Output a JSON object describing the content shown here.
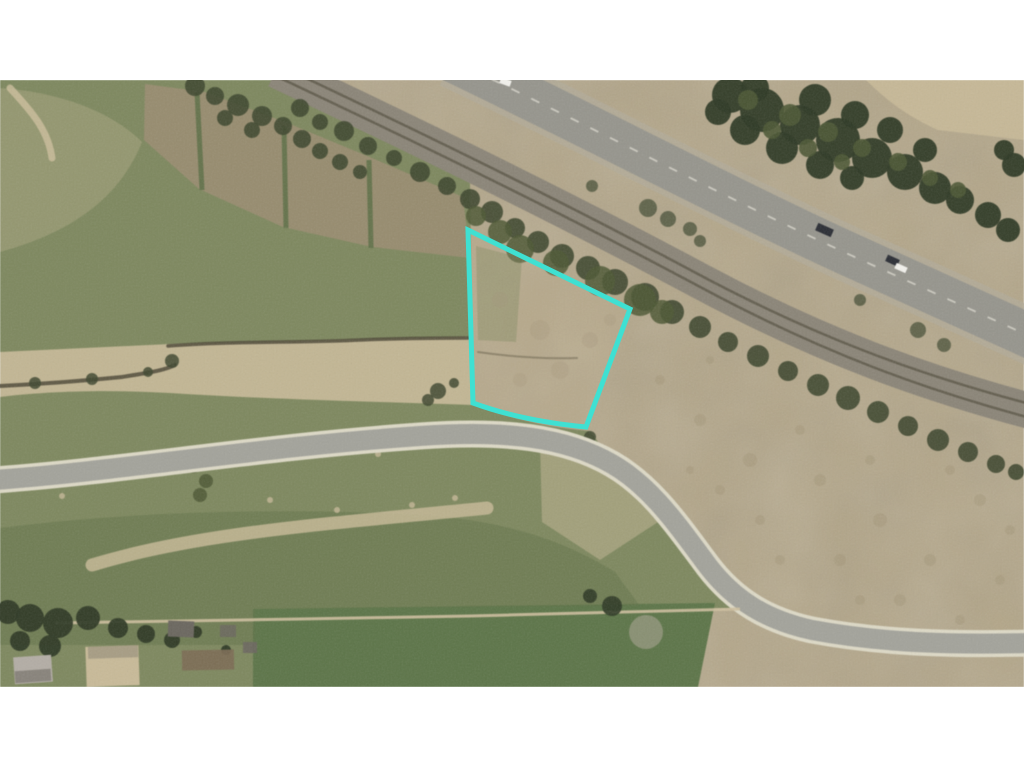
{
  "scene": {
    "width": 1024,
    "height": 768,
    "image_top": 80,
    "image_bottom": 687,
    "kind": "aerial-parcel-photo"
  },
  "palette": {
    "white": "#ffffff",
    "base_tan": "#b3a689",
    "dirt_light": "#c6b897",
    "dirt_dark": "#9b8d72",
    "grass": "#7e885f",
    "grass_dark": "#5f7048",
    "field_green": "#5d7549",
    "tree_dark": "#2f3a26",
    "tree_mid": "#4d5835",
    "bush": "#3f4830",
    "sage": "#8e9478",
    "road_gray": "#a3a39b",
    "road_edge": "#ddd9c6",
    "hwy_gray": "#96958d",
    "hwy_shoulder": "#b1ab9a",
    "hwy_line": "#d8d6cc",
    "rail_gray": "#8b8578",
    "rail_dark": "#544f3f",
    "ditch": "#4f4a38",
    "path_tan": "#cdbf9e",
    "roof_gray": "#b3ada5",
    "roof_dark": "#6b675f",
    "roof_tan": "#c8ba98",
    "garden_brown": "#7c6c54",
    "cyan": "#3fe0d2",
    "car_dark": "#2b2e35",
    "car_white": "#f2f1ec"
  },
  "parcel": {
    "stroke": "#3fe0d2",
    "stroke_width": 5,
    "vertices": [
      [
        468,
        230
      ],
      [
        630,
        309
      ],
      [
        586,
        427
      ],
      [
        473,
        403
      ]
    ]
  },
  "paths": {
    "imageArea": "M0,80 L1024,80 L1024,687 L0,687 Z",
    "grassMain": "M0,80 L285,80 C350,110 420,152 470,182 L473,403 C512,420 552,428 590,431 L628,482 C650,512 672,540 697,565 C715,583 733,597 752,608 L255,610 L255,687 L0,687 Z",
    "fieldBottom": "M253,609 L715,603 L698,687 L253,687 Z",
    "topRightField": "M866,80 L1024,80 L1024,140 L938,130 C906,116 884,98 866,80 Z",
    "washLight": "M0,88 C60,92 112,112 142,142 C122,192 80,230 0,252 Z",
    "washDark": "M0,528 C140,510 300,508 420,515 C500,520 560,538 615,572 L640,606 L255,609 L255,645 L0,645 Z",
    "washInnerCurve": "M540,442 L628,472 L658,522 L600,560 L542,522 Z",
    "ditchBand": "M0,352 L170,344 L470,337 L473,405 C390,402 280,400 170,393 C100,389 40,392 0,397 Z",
    "grassTuft": "M476,246 L522,258 L516,342 L478,340 Z",
    "stripsBand": "M145,84 L205,92 L290,124 L372,158 L463,197 L470,258 L372,247 L283,227 L199,189 L144,140 Z",
    "stripDiv1": "M197,92 L202,190",
    "stripDiv2": "M284,126 L286,228",
    "stripDiv3": "M369,160 L371,248",
    "trail": "M10,88 C28,108 48,128 52,158",
    "ribbon": "M92,565 C200,532 330,524 487,508",
    "farmPath": "M55,623 L300,619 L470,616 L740,609",
    "railBed": "M276,70 C420,138 560,206 700,281 C818,344 920,382 1034,412",
    "railLine1": "M272,62 C416,130 556,198 696,273 C814,336 916,374 1030,404",
    "railLine2": "M280,78 C424,146 564,214 704,289 C822,352 924,390 1038,420",
    "hwy": "M452,60 C590,126 722,196 846,253 C936,294 986,316 1038,340",
    "street": "M-6,480 C120,471 260,447 420,436 C505,430 565,437 612,464 C652,487 678,526 708,566 C734,600 766,620 812,630 C882,643 952,645 1030,643",
    "ditchUpper": "M168,346 C230,341 300,343 360,340 C405,338 442,338 468,338",
    "ditchLower": "M0,386 C40,384 82,381 122,377 C146,373 163,371 175,365",
    "ditchParcel": "M478,352 C512,357 546,359 577,358",
    "parcelOutline": "M468,230 L630,309 L586,427 Q522,421 473,403 Z"
  },
  "scatter": {
    "railBrush": {
      "fill": "bush",
      "op": 0.9,
      "pts": [
        [
          300,
          108,
          9
        ],
        [
          320,
          122,
          8
        ],
        [
          344,
          131,
          10
        ],
        [
          368,
          146,
          9
        ],
        [
          394,
          158,
          8
        ],
        [
          420,
          172,
          10
        ],
        [
          447,
          186,
          9
        ],
        [
          470,
          199,
          10
        ],
        [
          492,
          212,
          11
        ],
        [
          515,
          228,
          10
        ],
        [
          538,
          242,
          11
        ],
        [
          562,
          256,
          12
        ],
        [
          588,
          268,
          12
        ],
        [
          615,
          282,
          13
        ],
        [
          645,
          297,
          14
        ],
        [
          672,
          312,
          12
        ],
        [
          700,
          327,
          11
        ],
        [
          728,
          342,
          10
        ],
        [
          758,
          356,
          11
        ],
        [
          788,
          371,
          10
        ],
        [
          818,
          385,
          11
        ],
        [
          848,
          398,
          12
        ],
        [
          878,
          412,
          11
        ],
        [
          908,
          426,
          10
        ],
        [
          938,
          440,
          11
        ],
        [
          968,
          452,
          10
        ],
        [
          996,
          464,
          9
        ],
        [
          1016,
          472,
          8
        ]
      ]
    },
    "denseBrush": {
      "fill": "tree_mid",
      "op": 0.85,
      "pts": [
        [
          476,
          216,
          10
        ],
        [
          500,
          232,
          12
        ],
        [
          520,
          249,
          14
        ],
        [
          556,
          263,
          13
        ],
        [
          600,
          281,
          15
        ],
        [
          640,
          300,
          16
        ],
        [
          662,
          312,
          12
        ]
      ]
    },
    "topBrush": {
      "fill": "bush",
      "op": 0.9,
      "pts": [
        [
          195,
          86,
          10
        ],
        [
          215,
          96,
          9
        ],
        [
          238,
          105,
          11
        ],
        [
          262,
          116,
          10
        ],
        [
          283,
          126,
          9
        ],
        [
          225,
          118,
          8
        ],
        [
          252,
          130,
          8
        ],
        [
          302,
          139,
          9
        ],
        [
          320,
          151,
          8
        ],
        [
          340,
          162,
          8
        ],
        [
          360,
          172,
          7
        ]
      ]
    },
    "topRightTrees": {
      "fill": "tree_dark",
      "op": 0.95,
      "pts": [
        [
          730,
          95,
          18
        ],
        [
          762,
          110,
          22
        ],
        [
          800,
          125,
          20
        ],
        [
          838,
          140,
          22
        ],
        [
          872,
          158,
          20
        ],
        [
          905,
          172,
          18
        ],
        [
          935,
          188,
          16
        ],
        [
          960,
          200,
          14
        ],
        [
          988,
          215,
          13
        ],
        [
          1008,
          230,
          12
        ],
        [
          755,
          88,
          14
        ],
        [
          815,
          100,
          16
        ],
        [
          855,
          115,
          14
        ],
        [
          890,
          130,
          13
        ],
        [
          925,
          150,
          12
        ],
        [
          718,
          112,
          13
        ],
        [
          745,
          130,
          15
        ],
        [
          782,
          148,
          16
        ],
        [
          820,
          165,
          14
        ],
        [
          852,
          178,
          12
        ],
        [
          1014,
          165,
          12
        ],
        [
          1004,
          150,
          10
        ]
      ]
    },
    "topRightTreesLight": {
      "fill": "tree_mid",
      "op": 0.9,
      "pts": [
        [
          748,
          100,
          10
        ],
        [
          790,
          115,
          11
        ],
        [
          828,
          132,
          10
        ],
        [
          862,
          148,
          9
        ],
        [
          898,
          162,
          9
        ],
        [
          930,
          178,
          8
        ],
        [
          772,
          130,
          9
        ],
        [
          808,
          148,
          9
        ],
        [
          842,
          162,
          8
        ],
        [
          958,
          190,
          8
        ]
      ]
    },
    "medianBrush": {
      "fill": "bush",
      "op": 0.7,
      "pts": [
        [
          648,
          208,
          9
        ],
        [
          668,
          219,
          8
        ],
        [
          690,
          229,
          7
        ],
        [
          592,
          186,
          6
        ],
        [
          918,
          330,
          8
        ],
        [
          944,
          345,
          7
        ],
        [
          700,
          241,
          6
        ],
        [
          860,
          300,
          6
        ]
      ]
    },
    "ditchBushes": {
      "fill": "bush",
      "op": 0.85,
      "pts": [
        [
          35,
          383,
          6
        ],
        [
          92,
          379,
          6
        ],
        [
          148,
          372,
          5
        ],
        [
          172,
          361,
          7
        ],
        [
          438,
          391,
          8
        ],
        [
          428,
          400,
          6
        ],
        [
          454,
          383,
          5
        ],
        [
          590,
          437,
          6
        ]
      ]
    },
    "streetBushes": {
      "fill": "tree_mid",
      "op": 0.85,
      "pts": [
        [
          193,
          464,
          9
        ],
        [
          206,
          481,
          7
        ],
        [
          200,
          495,
          7
        ],
        [
          288,
          450,
          4
        ]
      ]
    },
    "bottomTrees": {
      "fill": "tree_dark",
      "op": 0.95,
      "pts": [
        [
          8,
          612,
          12
        ],
        [
          30,
          618,
          14
        ],
        [
          58,
          623,
          15
        ],
        [
          88,
          618,
          12
        ],
        [
          118,
          628,
          10
        ],
        [
          146,
          634,
          9
        ],
        [
          172,
          640,
          8
        ],
        [
          20,
          641,
          10
        ],
        [
          50,
          646,
          11
        ],
        [
          196,
          632,
          6
        ],
        [
          226,
          650,
          5
        ]
      ]
    },
    "bottomMidTrees": {
      "fill": "tree_dark",
      "op": 0.9,
      "pts": [
        [
          612,
          606,
          10
        ],
        [
          590,
          596,
          7
        ]
      ]
    },
    "sageBush": {
      "fill": "sage",
      "op": 0.9,
      "pts": [
        [
          646,
          632,
          17
        ]
      ]
    },
    "grassSpecks": {
      "fill": "dirt_light",
      "op": 0.8,
      "pts": [
        [
          62,
          496,
          3
        ],
        [
          97,
          472,
          3
        ],
        [
          187,
          470,
          3
        ],
        [
          282,
          456,
          3
        ],
        [
          378,
          454,
          3
        ],
        [
          270,
          500,
          3
        ],
        [
          337,
          510,
          3
        ],
        [
          412,
          505,
          3
        ],
        [
          455,
          498,
          3
        ],
        [
          497,
          440,
          2
        ],
        [
          150,
          455,
          2
        ],
        [
          230,
          462,
          2
        ],
        [
          240,
          443,
          2
        ],
        [
          253,
          441,
          2
        ]
      ]
    },
    "dirtMottle": {
      "fill": "dirt_dark",
      "op": 0.3,
      "pts": [
        [
          700,
          420,
          6
        ],
        [
          750,
          460,
          7
        ],
        [
          820,
          480,
          6
        ],
        [
          880,
          520,
          7
        ],
        [
          930,
          560,
          6
        ],
        [
          980,
          500,
          6
        ],
        [
          760,
          520,
          5
        ],
        [
          840,
          560,
          6
        ],
        [
          900,
          600,
          6
        ],
        [
          960,
          620,
          5
        ],
        [
          1000,
          580,
          5
        ],
        [
          720,
          490,
          5
        ],
        [
          800,
          430,
          5
        ],
        [
          870,
          460,
          5
        ],
        [
          950,
          470,
          5
        ],
        [
          1010,
          530,
          5
        ],
        [
          690,
          470,
          4
        ],
        [
          780,
          560,
          5
        ],
        [
          860,
          600,
          5
        ],
        [
          920,
          640,
          4
        ],
        [
          660,
          380,
          5
        ],
        [
          710,
          360,
          4
        ]
      ]
    },
    "parcelMottle": {
      "fill": "dirt_dark",
      "op": 0.25,
      "pts": [
        [
          500,
          300,
          8
        ],
        [
          540,
          330,
          10
        ],
        [
          560,
          370,
          9
        ],
        [
          520,
          380,
          7
        ],
        [
          590,
          340,
          8
        ],
        [
          610,
          320,
          6
        ]
      ]
    }
  },
  "rects": {
    "vehicles": [
      {
        "x": 816,
        "y": 226,
        "w": 17,
        "h": 8,
        "rot": 24,
        "fill": "car_dark"
      },
      {
        "x": 886,
        "y": 257,
        "w": 13,
        "h": 7,
        "rot": 24,
        "fill": "car_dark"
      },
      {
        "x": 895,
        "y": 265,
        "w": 12,
        "h": 6,
        "rot": 24,
        "fill": "car_white"
      },
      {
        "x": 500,
        "y": 79,
        "w": 11,
        "h": 6,
        "rot": 20,
        "fill": "car_white"
      }
    ],
    "buildings": [
      {
        "x": 14,
        "y": 656,
        "w": 38,
        "h": 27,
        "rot": -4,
        "fill": "roof_gray"
      },
      {
        "x": 15,
        "y": 670,
        "w": 36,
        "h": 12,
        "rot": -4,
        "fill": "roof_dark",
        "op": 0.6
      },
      {
        "x": 86,
        "y": 646,
        "w": 53,
        "h": 40,
        "rot": -2,
        "fill": "roof_tan"
      },
      {
        "x": 88,
        "y": 646,
        "w": 50,
        "h": 12,
        "rot": -2,
        "fill": "roof_dark",
        "op": 0.35
      },
      {
        "x": 168,
        "y": 621,
        "w": 26,
        "h": 16,
        "rot": 2,
        "fill": "roof_dark"
      },
      {
        "x": 220,
        "y": 625,
        "w": 16,
        "h": 12,
        "rot": 0,
        "fill": "roof_dark",
        "op": 0.8
      },
      {
        "x": 243,
        "y": 642,
        "w": 14,
        "h": 11,
        "rot": 0,
        "fill": "roof_dark",
        "op": 0.9
      },
      {
        "x": 182,
        "y": 650,
        "w": 52,
        "h": 20,
        "rot": -1,
        "fill": "garden_brown",
        "op": 0.9
      }
    ]
  }
}
